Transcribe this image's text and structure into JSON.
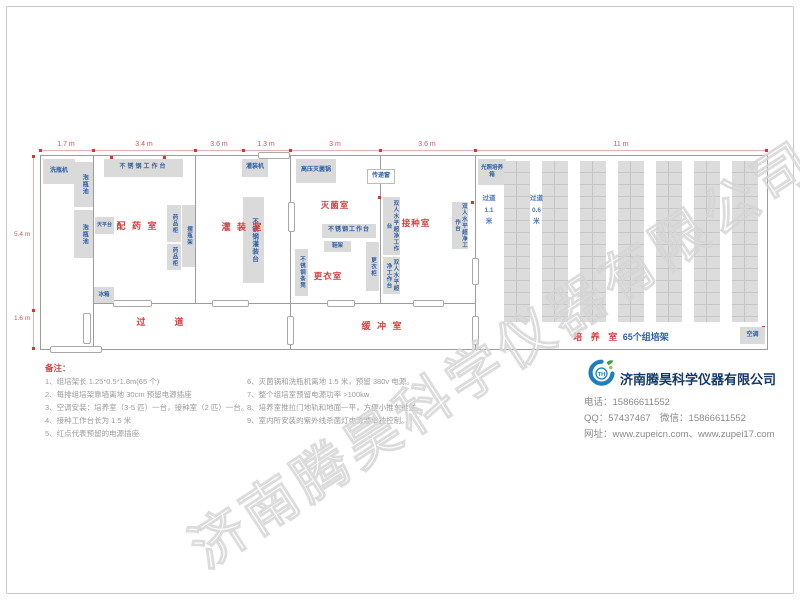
{
  "dimensions": {
    "top": [
      "1.7 m",
      "3.4 m",
      "3.6 m",
      "1.3 m",
      "3 m",
      "3.6 m",
      "11 m"
    ],
    "left_upper": "5.4 m",
    "left_lower": "1.6 m"
  },
  "rooms": {
    "prep": "配 药 室",
    "filling": "灌 装 室",
    "corridor": "过　道",
    "sterilize": "灭菌室",
    "changing": "更衣室",
    "inoculation": "接种室",
    "buffer": "缓 冲 室",
    "culture": "培 养 室",
    "culture_sub": "65个组培架"
  },
  "equipment": {
    "washer": "洗瓶机",
    "soak1": "泡瓶池",
    "soak2": "泡瓶池",
    "worktable_prep": "不锈钢工作台",
    "filler": "灌装机",
    "balance": "天平台",
    "cabinet1": "药品柜",
    "cabinet2": "药品柜",
    "bottle_rack": "摆瓶架",
    "fridge": "冰箱",
    "filling_table": "不锈钢灌装台",
    "autoclave": "高压灭菌锅",
    "pass_window": "传递窗",
    "worktable_ster": "不锈钢工作台",
    "shoe_rack": "鞋架",
    "bench": "不锈钢条凳",
    "locker": "更衣柜",
    "clean_bench1": "双人水平超净工作台",
    "clean_bench2": "双人水平超净工作台",
    "clean_bench3": "双人水平超净工作台",
    "incubator": "光照培养箱",
    "ac": "空调",
    "aisle_wide": "过道 1.1 米",
    "aisle_narrow": "过道 0.6 米"
  },
  "notes": {
    "title": "备注：",
    "left": [
      "1、组培架长 1.25*0.5*1.8m(65 个)",
      "2、每排组培架靠墙离地 30cm 预留电源插座",
      "3、空调安装：培养室（3-5 匹）一台，接种室（2 匹）一台。",
      "4、接种工作台长为 1.5 米",
      "5、红点代表预留的电源插座"
    ],
    "right": [
      "6、灭菌锅和洗瓶机离地 1.5 米，预留 380v 电源。",
      "7、整个组培室预留电源功率 >100kw",
      "8、培养室推拉门地轨和地面一平，方便小推车推送。",
      "9、室内所安装的紫外线杀菌灯电源要单独控制。"
    ]
  },
  "company": {
    "name": "济南腾昊科学仪器有限公司",
    "phone": "电话：15866611552",
    "qq_wechat": "QQ：57437467　微信：15866611552",
    "web": "网址：www.zupeicn.com、www.zupei17.com"
  },
  "watermark": "济南腾昊科学仪器有限公司"
}
